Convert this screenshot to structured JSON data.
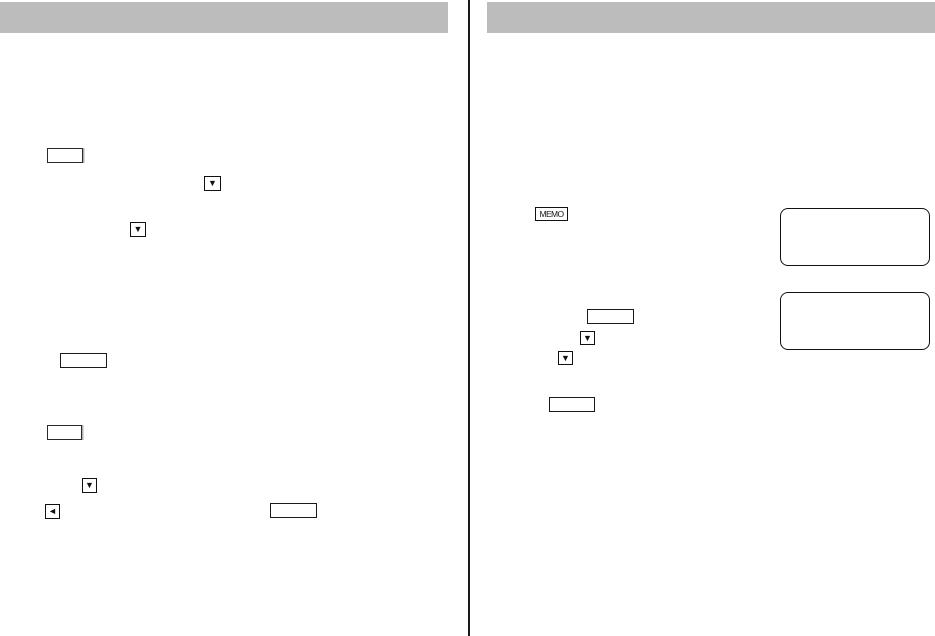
{
  "document": {
    "kind": "scanned manual page, two columns, text not rendered",
    "memo_badge": {
      "label": "MEMO"
    },
    "icons": {
      "down_triangle": "▼",
      "left_triangle": "◄"
    },
    "colors": {
      "header_bar_gray": "#bcbcbc",
      "line_black": "#1a1a1a",
      "page_background": "#ffffff",
      "box_shadow_gray": "#b0b0b0"
    }
  }
}
